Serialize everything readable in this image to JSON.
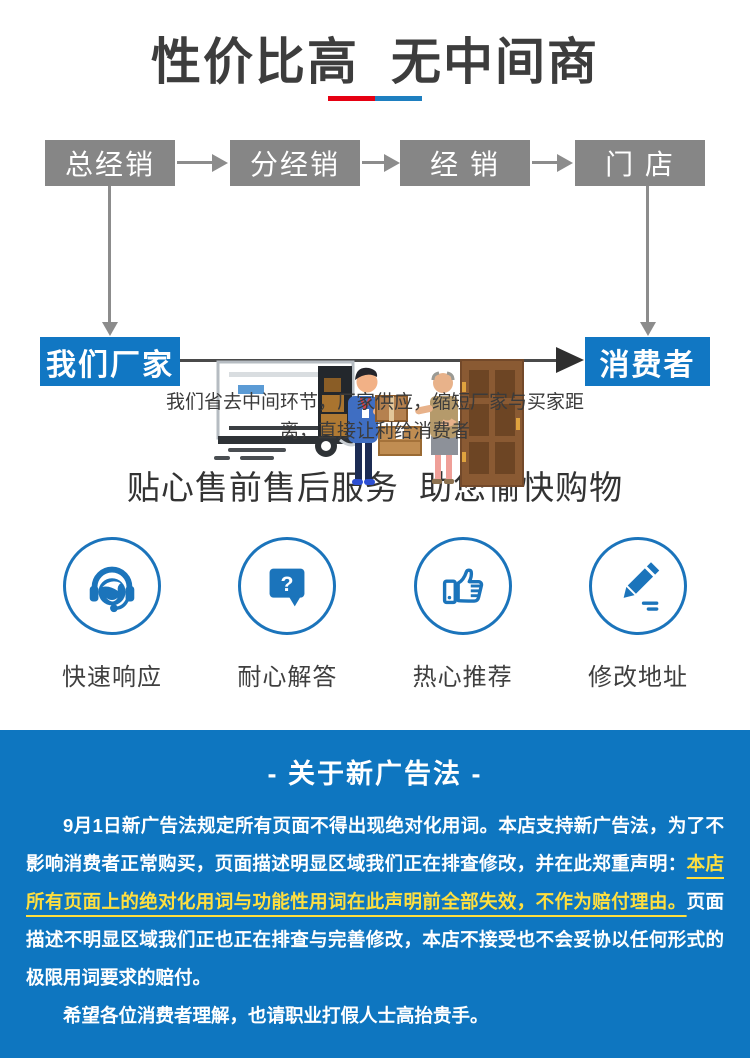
{
  "hero": {
    "title": "性价比高 无中间商",
    "underline_red": "#e60012",
    "underline_blue": "#1e7fc0"
  },
  "flow": {
    "middle_boxes": [
      "总经销",
      "分经销",
      "经 销",
      "门 店"
    ],
    "left_box": "我们厂家",
    "right_box": "消费者",
    "caption": "我们省去中间环节，厂家供应，缩短厂家与买家距离，直接让利给消费者",
    "box_gray": "#868686",
    "box_blue": "#1177c3"
  },
  "services": {
    "title": "贴心售前售后服务 助您愉快购物",
    "icon_blue": "#1b74bb",
    "items": [
      {
        "icon": "headset-icon",
        "label": "快速响应"
      },
      {
        "icon": "question-bubble-icon",
        "label": "耐心解答"
      },
      {
        "icon": "thumbs-up-icon",
        "label": "热心推荐"
      },
      {
        "icon": "pencil-icon",
        "label": "修改地址"
      }
    ]
  },
  "notice": {
    "title": "- 关于新广告法 -",
    "paragraph_part1": "9月1日新广告法规定所有页面不得出现绝对化用词。本店支持新广告法，为了不影响消费者正常购买，页面描述明显区域我们正在排查修改，并在此郑重声明：",
    "paragraph_highlight": "本店所有页面上的绝对化用词与功能性用词在此声明前全部失效，不作为赔付理由。",
    "paragraph_part2": "页面描述不明显区域我们正也正在排查与完善修改，本店不接受也不会妥协以任何形式的极限用词要求的赔付。",
    "closing": "希望各位消费者理解，也请职业打假人士高抬贵手。",
    "background_blue": "#0e76c0",
    "highlight_yellow": "#ffdf3f"
  }
}
